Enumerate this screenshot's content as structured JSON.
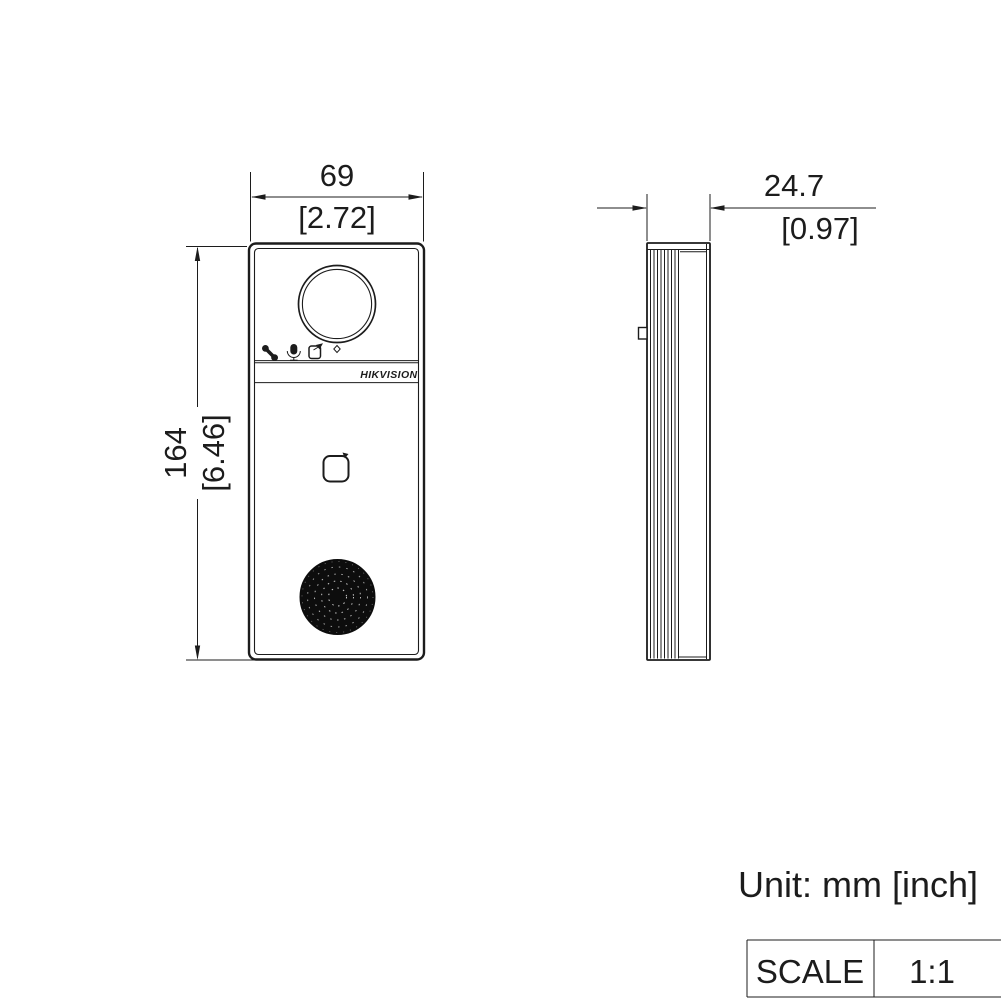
{
  "drawing": {
    "type": "product-dimension-drawing",
    "brand_logo": "HIKVISION",
    "unit_note": "Unit: mm [inch]",
    "scale": {
      "label": "SCALE",
      "value": "1:1"
    },
    "dimensions": {
      "width": {
        "mm": "69",
        "inch": "[2.72]"
      },
      "height": {
        "mm": "164",
        "inch": "[6.46]"
      },
      "depth": {
        "mm": "24.7",
        "inch": "[0.97]"
      }
    },
    "icons": {
      "front_panel": [
        "phone-icon",
        "microphone-icon",
        "door-release-icon"
      ]
    },
    "colors": {
      "line": "#1c1c1c",
      "background": "#ffffff",
      "speaker_fill": "#0d0d0d"
    }
  }
}
